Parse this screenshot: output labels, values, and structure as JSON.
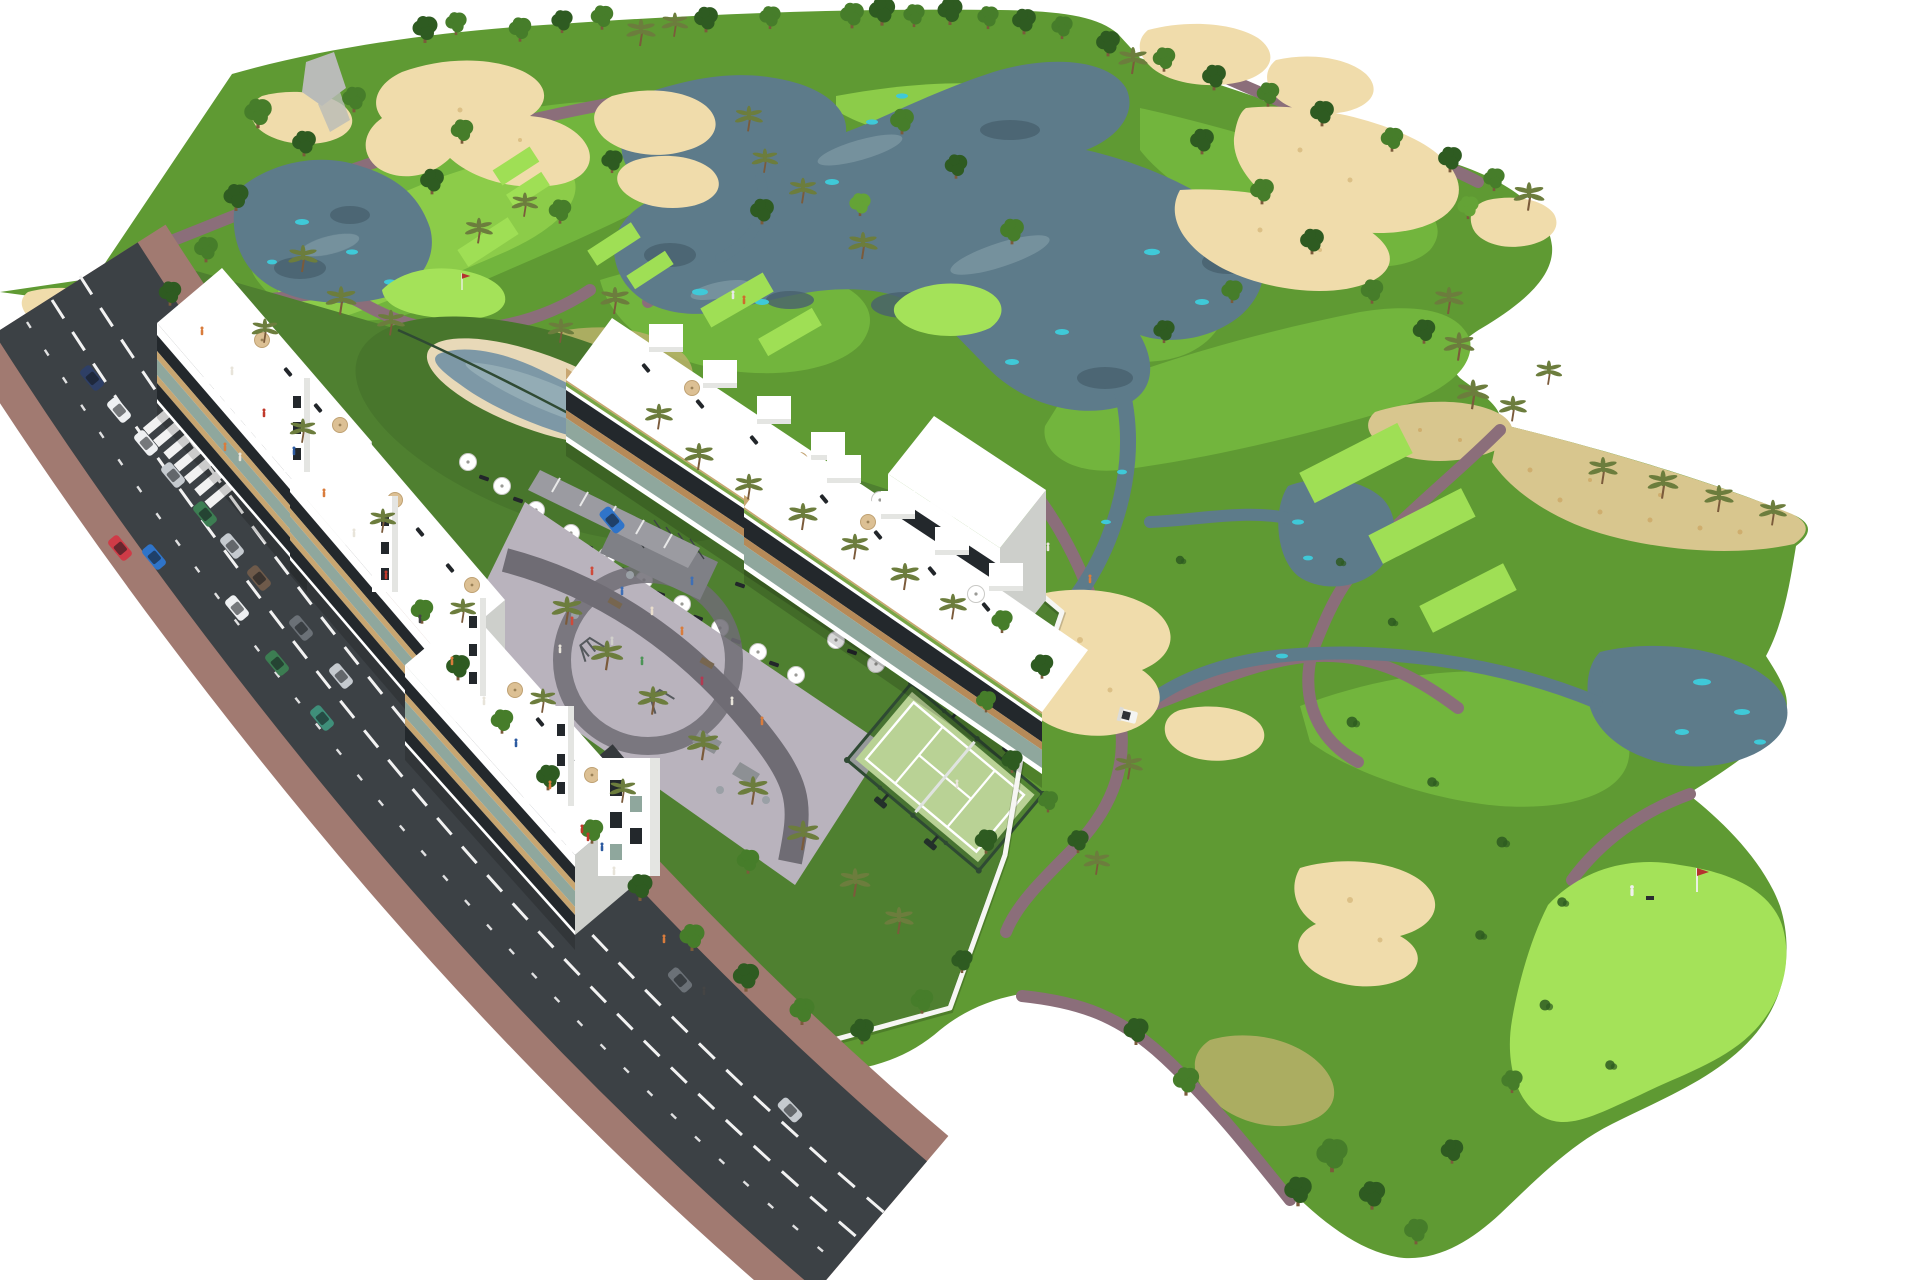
{
  "scene": {
    "type": "aerial-3d-architectural-rendering",
    "subject": "white apartment and townhouse resort development beside an 18-hole golf course",
    "visible_text": [],
    "features": [
      "golf-course-fairways",
      "putting-greens-with-flags",
      "tee-boxes",
      "sand-bunkers",
      "lakes-and-streams",
      "cart-paths",
      "access-road-with-crosswalks",
      "parked-cars",
      "moving-cars",
      "pedestrians",
      "apartment-block-row",
      "townhouse-row-with-pergolas",
      "rooftop-terraces-with-loungers",
      "lagoon-swimming-pool",
      "pool-lawn-with-parasols",
      "central-plaza-playground",
      "bike-racks",
      "padel-court",
      "white-perimeter-walls",
      "palm-trees",
      "golf-cart",
      "golfers"
    ]
  },
  "colors": {
    "bg": "#ffffff",
    "rough": "#5f9a33",
    "fairway": "#72b53d",
    "bright": "#8ccc49",
    "tee": "#9fdf55",
    "green2": "#a4e259",
    "sand": "#f0dcab",
    "sandSpeck": "#cfae6e",
    "drygrass": "#b8b06a",
    "scrub": "#d8c68e",
    "water": "#5d7b8a",
    "waterDeep": "#49616e",
    "waterLight": "#7e98a3",
    "teal": "#3fc9d8",
    "path": "#8b6e7a",
    "road": "#3c4145",
    "sidewalk": "#a17a71",
    "lane": "#f2f2f2",
    "parcelGrass": "#4f8030",
    "lawn": "#48762c",
    "plaza": "#b9b3bd",
    "plazaPath": "#6f6c74",
    "bikePad": "#7f8086",
    "court": "#b9d295",
    "courtLine": "#ffffff",
    "fence": "#2f4a33",
    "wall": "#f6f6f3",
    "bld": "#ffffff",
    "bldShade": "#e4e5e2",
    "bldSide": "#cdcfcb",
    "glass": "#23282c",
    "glassGreen": "#8fa79d",
    "beige": "#c8a671",
    "wood": "#b68a58",
    "planter": "#79a646",
    "treeDark": "#2e5b21",
    "treeMid": "#467d2a",
    "treeLight": "#64a336",
    "palm": "#6c7d3d",
    "trunk": "#7b5b3b",
    "deck": "#e8d9b8",
    "poolWater": "#7d98a6",
    "poolWaterLight": "#93acb5",
    "lounger": "#22262a",
    "rock": "#b9bbb8",
    "carWhite": "#eef0f2",
    "carRed": "#cf3b47",
    "carBlue": "#2f74c9",
    "carGreen": "#3c7d52",
    "carSilver": "#c5cacf",
    "carNavy": "#2e3f66",
    "carGray": "#6b7177",
    "carBrown": "#6e5a4a",
    "carTeal": "#3f8f7a",
    "flag": "#b5332f"
  }
}
